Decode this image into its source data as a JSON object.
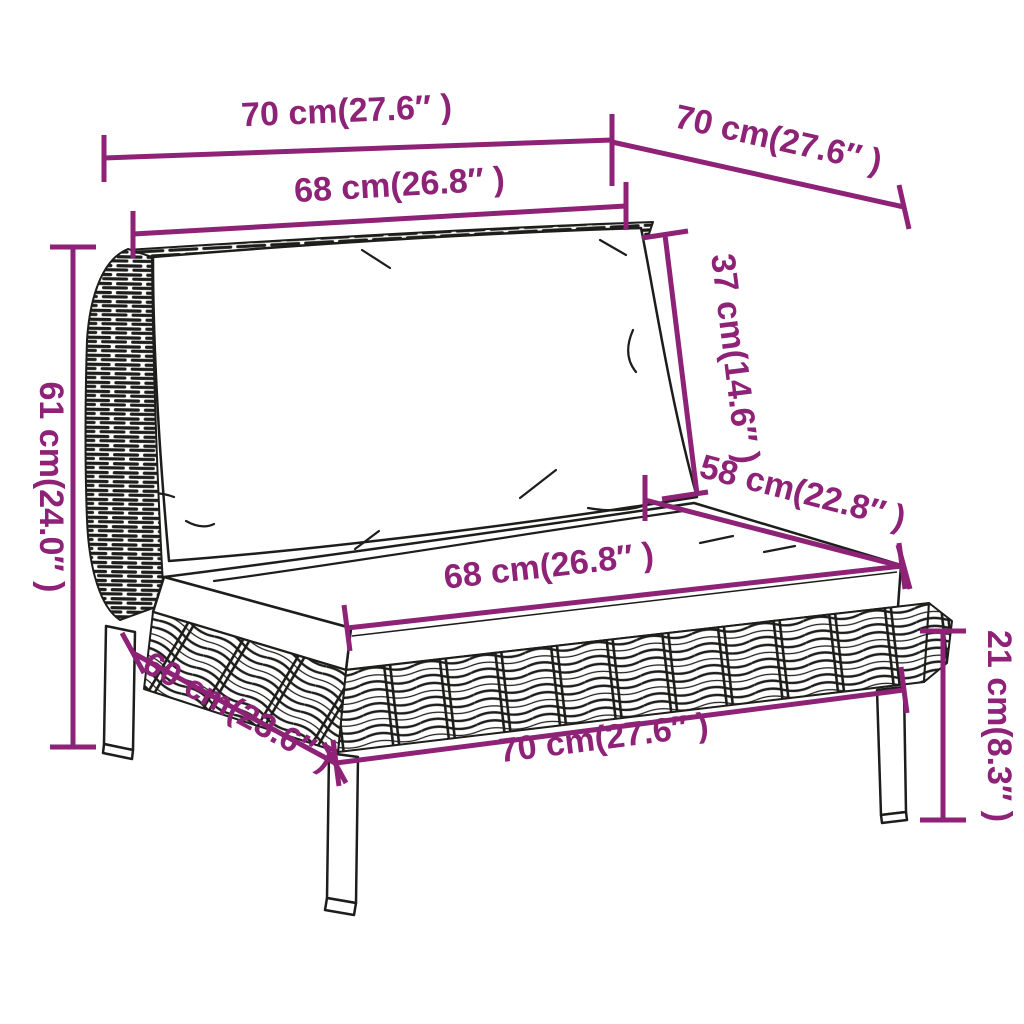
{
  "diagram": {
    "type": "furniture-dimension-diagram",
    "subject": "rattan-sofa-section-with-cushions",
    "colors": {
      "dimension_accent": "#8D2276",
      "line_art": "#1d1d1b",
      "background": "#ffffff"
    },
    "units": [
      "cm",
      "inches"
    ]
  },
  "dimensions": {
    "overall_width_top": {
      "label": "70 cm(27.6″ )",
      "cm": 70,
      "inches": 27.6
    },
    "overall_depth_top": {
      "label": "70 cm(27.6″ )",
      "cm": 70,
      "inches": 27.6
    },
    "back_cushion_width": {
      "label": "68 cm(26.8″ )",
      "cm": 68,
      "inches": 26.8
    },
    "back_cushion_height": {
      "label": "37 cm(14.6″ )",
      "cm": 37,
      "inches": 14.6
    },
    "overall_height": {
      "label": "61 cm(24.0″ )",
      "cm": 61,
      "inches": 24.0
    },
    "seat_depth": {
      "label": "58 cm(22.8″ )",
      "cm": 58,
      "inches": 22.8
    },
    "seat_cushion_width": {
      "label": "68 cm(26.8″ )",
      "cm": 68,
      "inches": 26.8
    },
    "leg_height": {
      "label": "21 cm(8.3″ )",
      "cm": 21,
      "inches": 8.3
    },
    "base_depth": {
      "label": "60 cm(23.6″ )",
      "cm": 60,
      "inches": 23.6
    },
    "base_width": {
      "label": "70 cm(27.6″ )",
      "cm": 70,
      "inches": 27.6
    }
  }
}
